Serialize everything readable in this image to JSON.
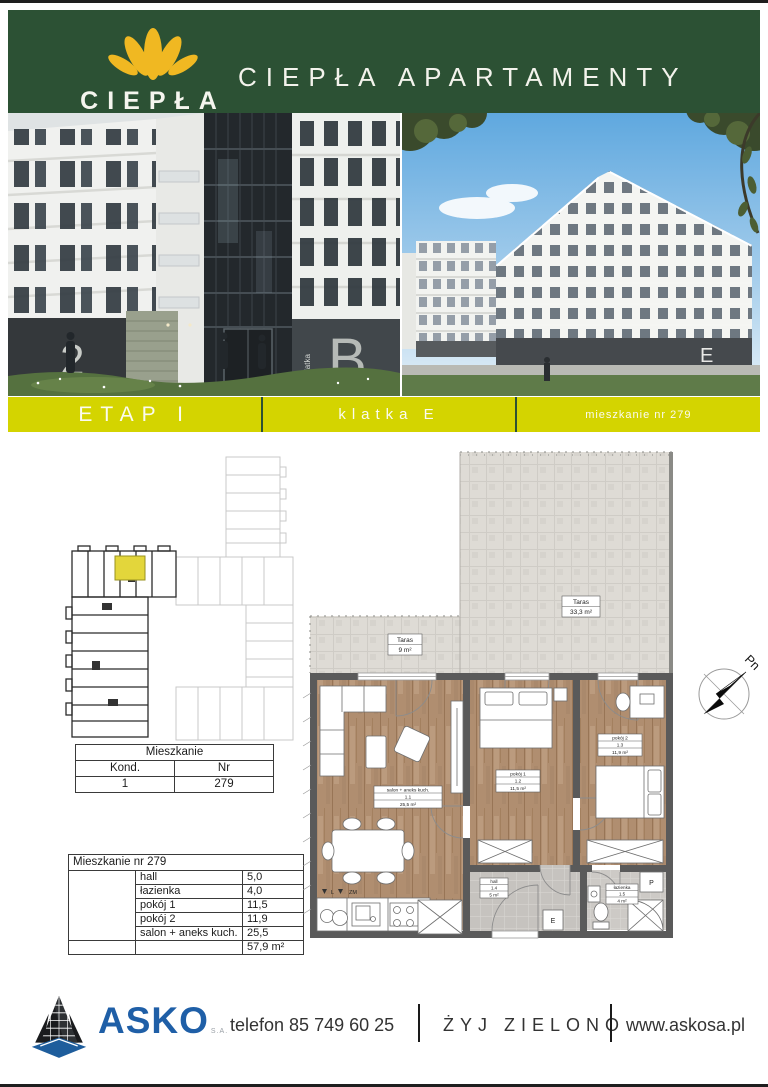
{
  "header": {
    "logo_title": "CIEPŁA",
    "logo_subtitle": "APARTAMENTY",
    "title": "CIEPŁA APARTAMENTY"
  },
  "banner": {
    "etap": "ETAP I",
    "klatka": "klatka E",
    "mieszkanie": "mieszkanie nr 279"
  },
  "photos": {
    "left_building_letter": "B",
    "left_garage_number": "2",
    "left_sign_vertical": "klatka",
    "right_building_letter": "E"
  },
  "unit_table": {
    "title": "Mieszkanie",
    "col_kond": "Kond.",
    "col_nr": "Nr",
    "kond": "1",
    "nr": "279"
  },
  "rooms_table": {
    "title": "Mieszkanie nr 279",
    "rows": [
      [
        "hall",
        "5,0"
      ],
      [
        "łazienka",
        "4,0"
      ],
      [
        "pokój 1",
        "11,5"
      ],
      [
        "pokój 2",
        "11,9"
      ],
      [
        "salon + aneks kuch.",
        "25,5"
      ]
    ],
    "total_area": "57,9 m²"
  },
  "floorplan": {
    "taras_large_name": "Taras",
    "taras_large_area": "33,3 m²",
    "taras_small_name": "Taras",
    "taras_small_area": "9 m²",
    "salon_name": "salon + aneks kuch.",
    "salon_id": "1.1",
    "salon_area": "25,5 m²",
    "pokoj1_name": "pokój 1",
    "pokoj1_id": "1.2",
    "pokoj1_area": "11,5 m²",
    "pokoj2_name": "pokój 2",
    "pokoj2_id": "1.3",
    "pokoj2_area": "11,9 m²",
    "hall_name": "hall",
    "hall_id": "1.4",
    "hall_area": "5 m²",
    "lazienka_name": "łazienka",
    "lazienka_id": "1.5",
    "lazienka_area": "4 m²",
    "compass_north": "Pn",
    "label_l": "L",
    "label_zm": "ZM",
    "label_p": "P",
    "label_e": "E"
  },
  "footer": {
    "brand": "ASKO",
    "brand_suffix": "S.A.",
    "phone": "telefon 85 749 60 25",
    "slogan": "ŻYJ ZIELONO",
    "website": "www.askosa.pl"
  },
  "colors": {
    "header_green": "#2c5134",
    "banner_yellow": "#d4d400",
    "logo_gold": "#f0b822",
    "brand_blue": "#1f5fa7"
  }
}
